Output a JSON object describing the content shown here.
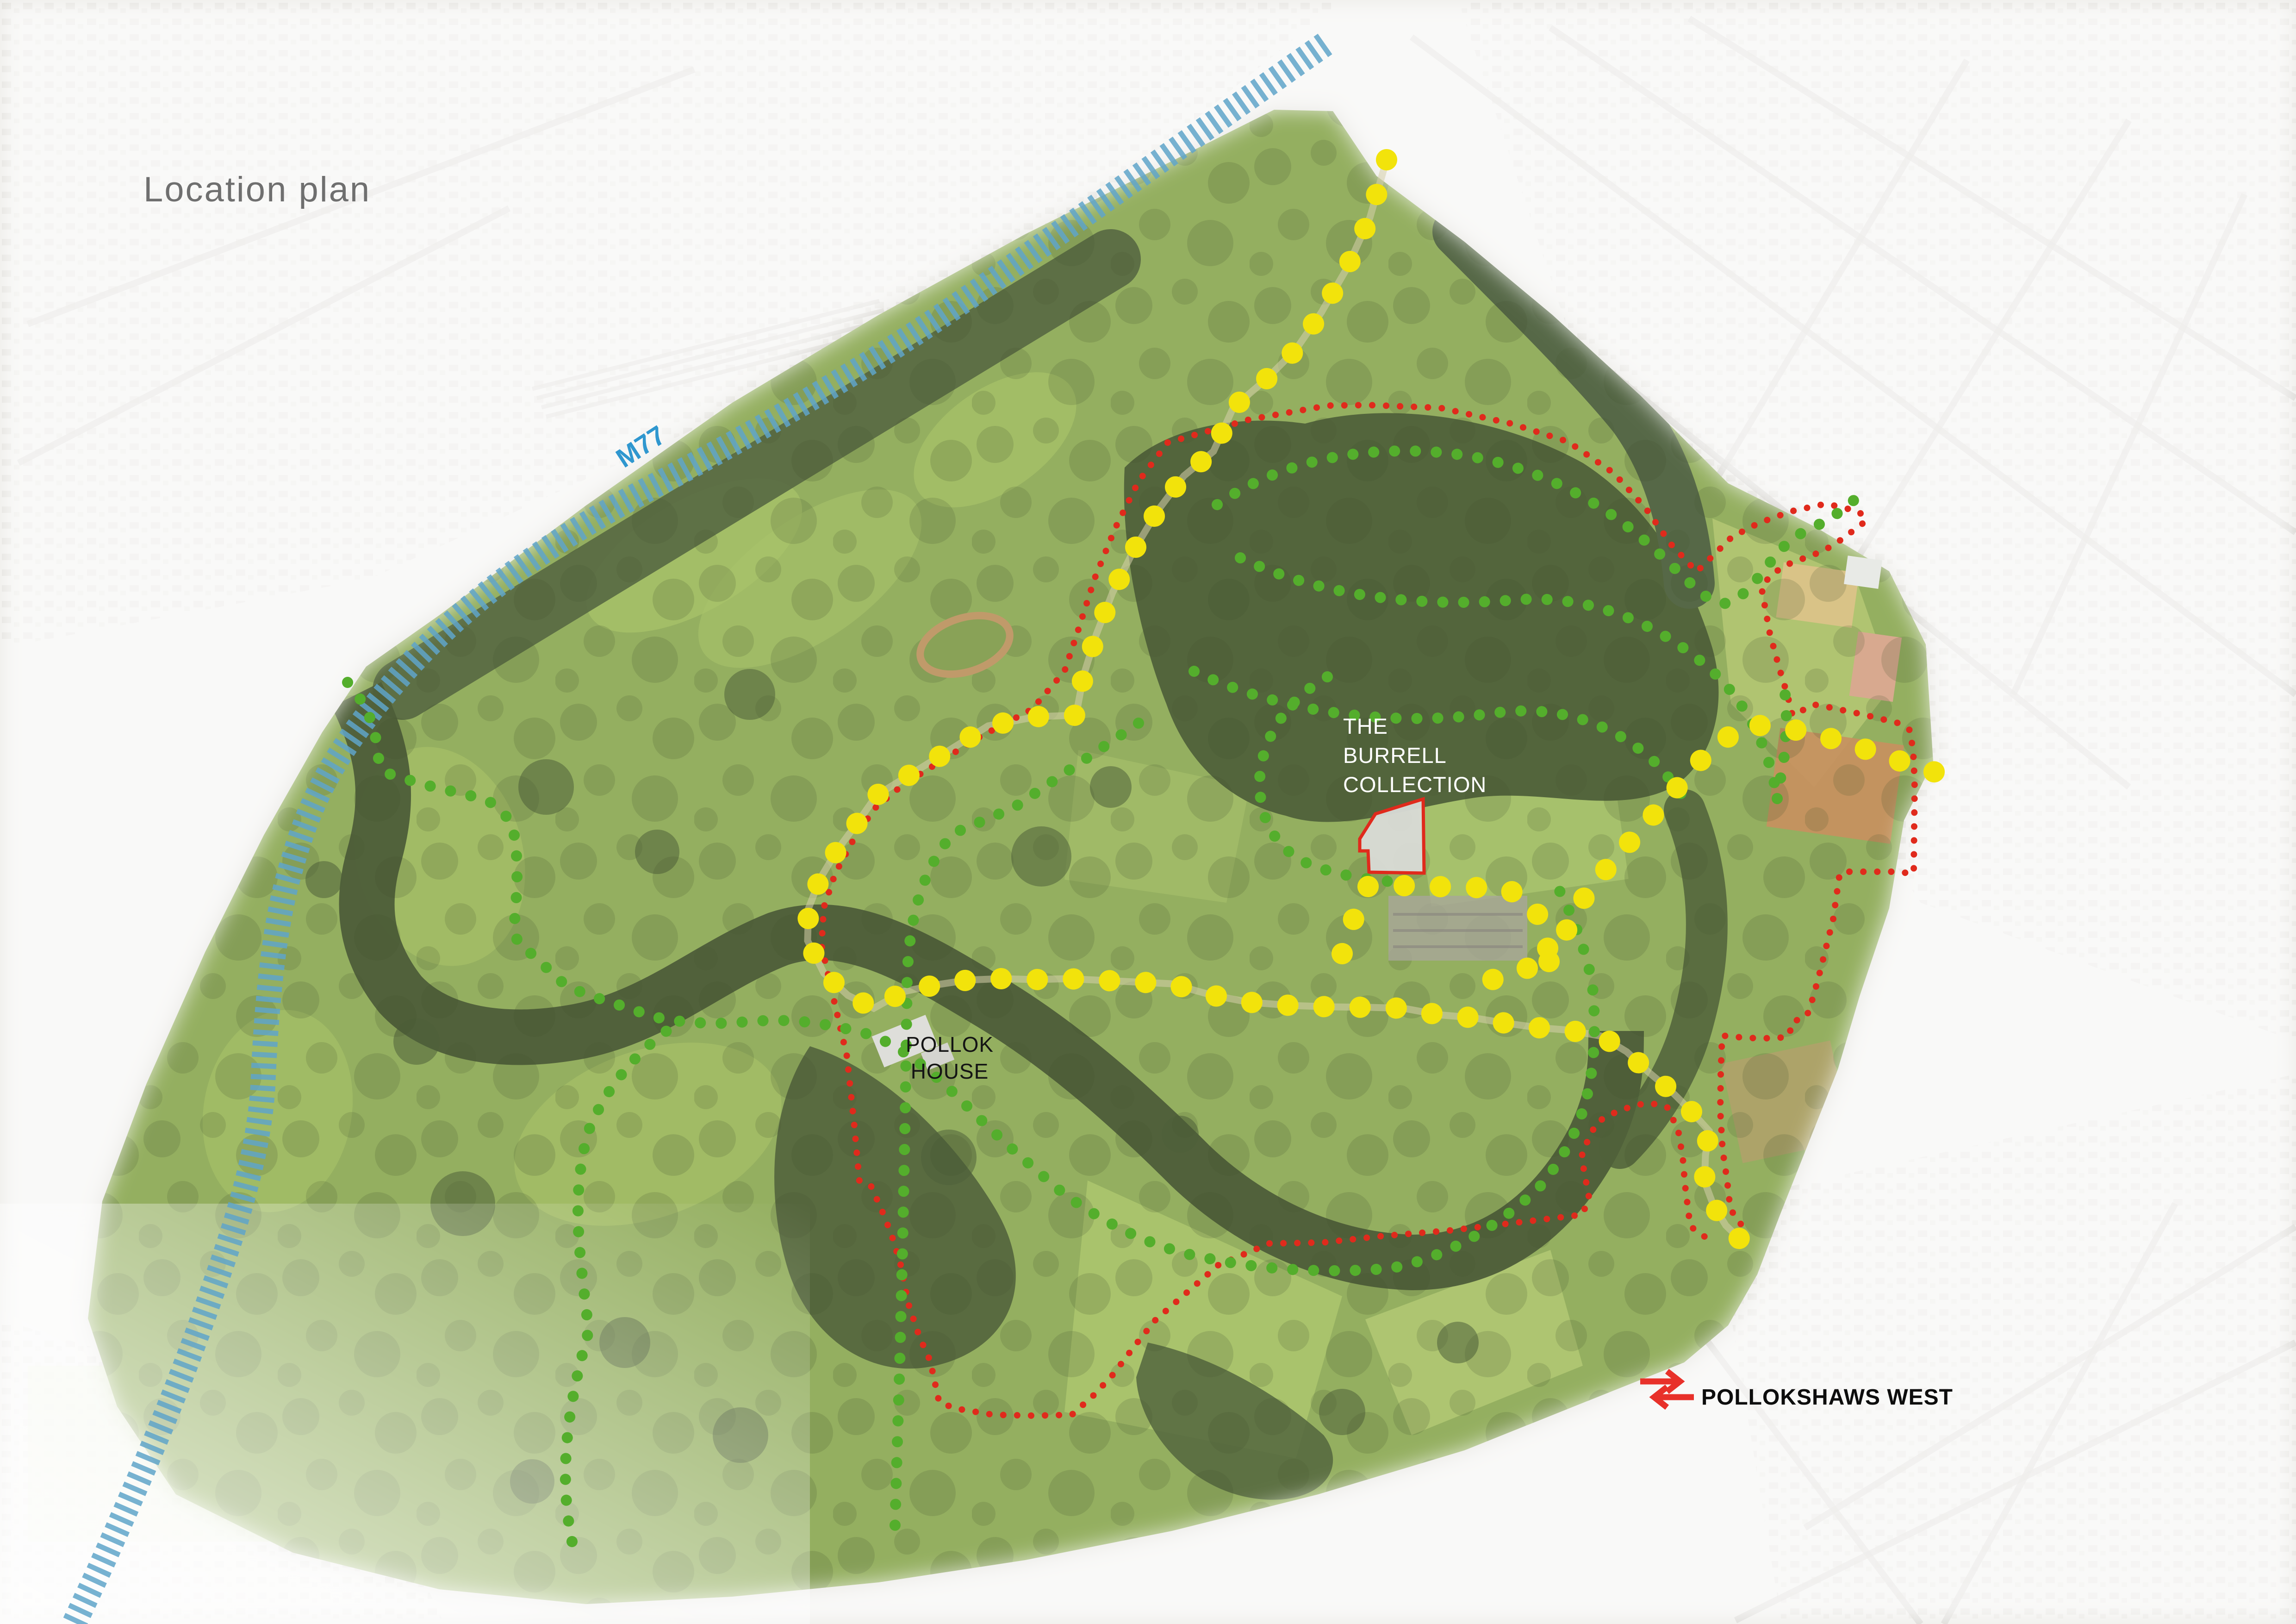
{
  "page": {
    "title": "Location plan",
    "title_color": "#6f6f6f"
  },
  "map": {
    "labels": {
      "motorway": {
        "text": "M77",
        "color": "#2f97cf"
      },
      "burrell": {
        "line1": "THE",
        "line2": "BURRELL",
        "line3": "COLLECTION",
        "color": "#ffffff"
      },
      "pollok_house": {
        "line1": "POLLOK",
        "line2": "HOUSE",
        "color": "#141414"
      },
      "station": {
        "text": "POLLOKSHAWS WEST",
        "color": "#0d0d0d"
      }
    },
    "routes": {
      "yellow": {
        "id": "core-route-yellow-dots",
        "color": "#f2e30b"
      },
      "green": {
        "id": "woodland-paths-green-dots",
        "color": "#54ae2c"
      },
      "red": {
        "id": "site-boundary-red-dots",
        "color": "#e02a1c"
      },
      "blue": {
        "id": "m77-motorway-hatch",
        "color": "#5fa5c9"
      }
    },
    "icons": {
      "rail": {
        "name": "national-rail-icon",
        "color": "#e8312a"
      }
    }
  }
}
